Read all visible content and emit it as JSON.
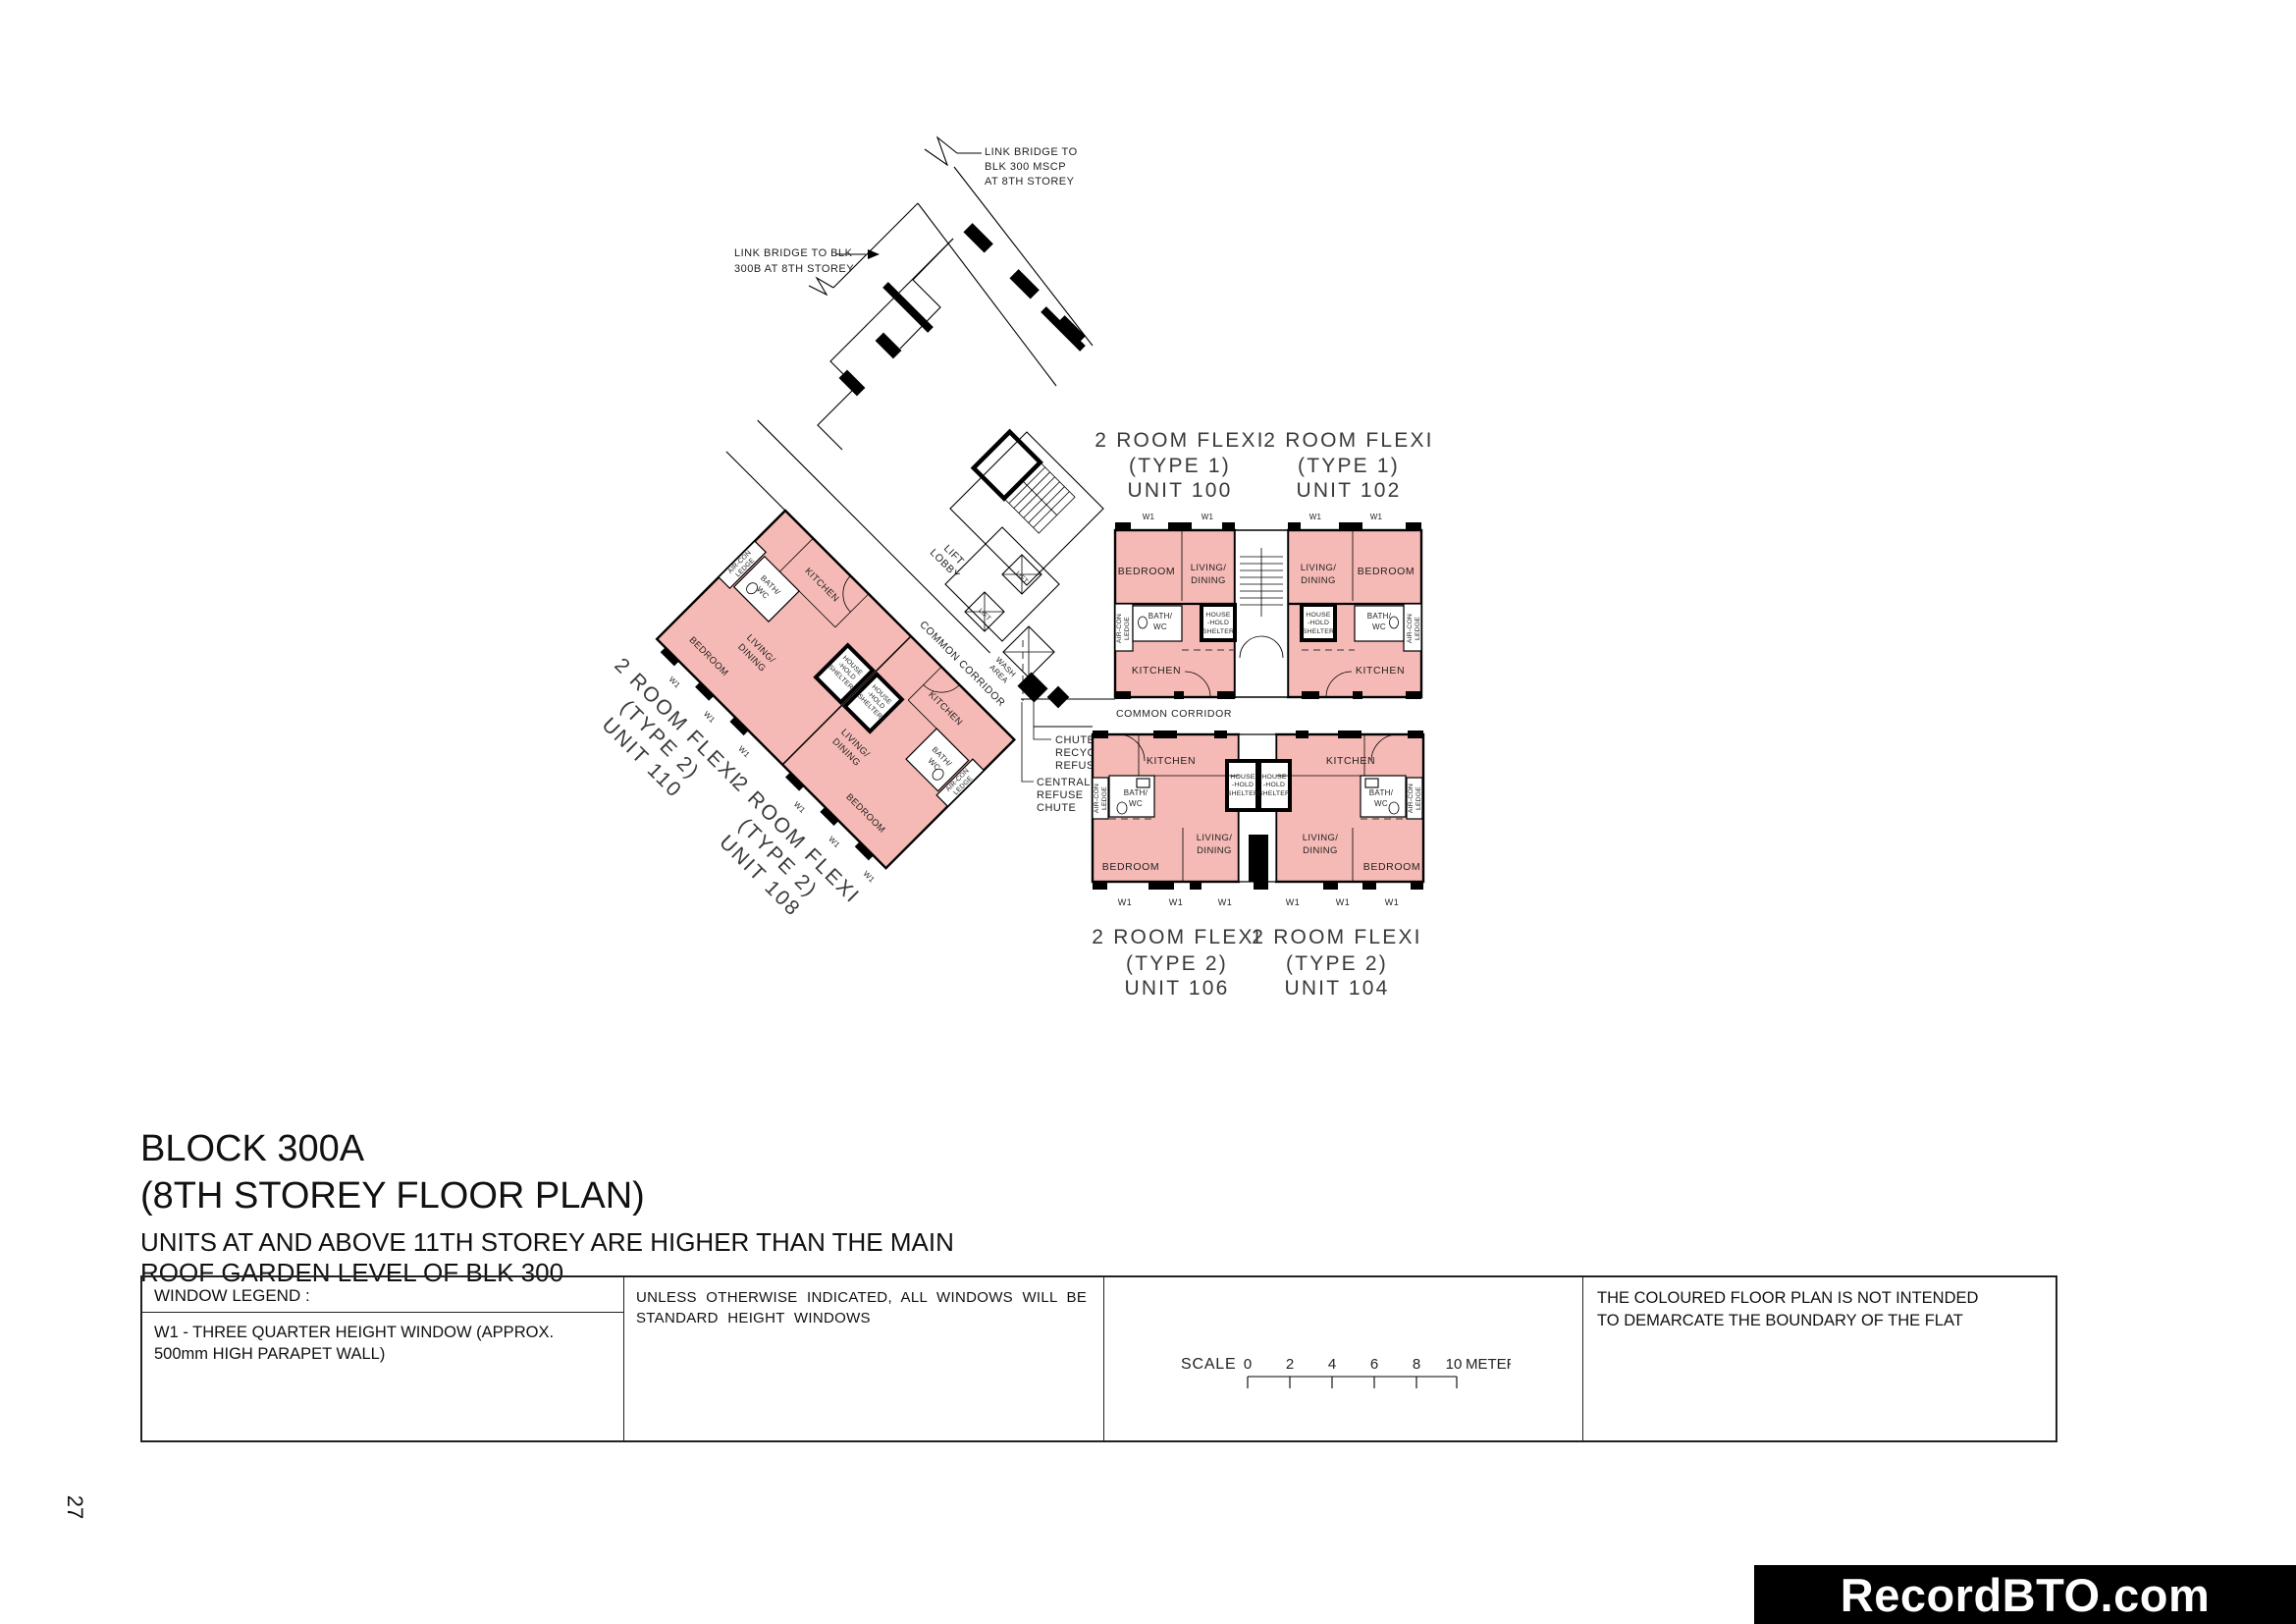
{
  "page": {
    "number": "27"
  },
  "watermark": {
    "text": "RecordBTO.com"
  },
  "title_block": {
    "block": "BLOCK 300A",
    "subtitle": "(8TH STOREY FLOOR PLAN)",
    "note_line1": "UNITS AT AND ABOVE 11TH STOREY ARE HIGHER THAN THE MAIN",
    "note_line2": "ROOF GARDEN LEVEL OF BLK 300"
  },
  "legend": {
    "window_legend_title": "WINDOW LEGEND :",
    "window_legend_item": "W1 - THREE QUARTER HEIGHT WINDOW (APPROX. 500mm HIGH PARAPET WALL)",
    "windows_note_line1": "UNLESS OTHERWISE INDICATED, ALL WINDOWS WILL BE",
    "windows_note_line2": "STANDARD HEIGHT WINDOWS",
    "scale_label": "SCALE",
    "scale_ticks": [
      "0",
      "2",
      "4",
      "6",
      "8",
      "10"
    ],
    "scale_unit": "METER",
    "coloured_note_line1": "THE COLOURED FLOOR PLAN IS NOT INTENDED",
    "coloured_note_line2": "TO DEMARCATE THE BOUNDARY OF THE FLAT"
  },
  "plan": {
    "colors": {
      "unit_fill": "#f6bab6",
      "wall": "#000000"
    },
    "rooms": {
      "bedroom": "BEDROOM",
      "living1": "LIVING/",
      "living2": "DINING",
      "kitchen": "KITCHEN",
      "bath1": "BATH/",
      "bath2": "WC",
      "hh1": "HOUSE",
      "hh2": "-HOLD",
      "hh3": "SHELTER",
      "ac1": "AIR-CON",
      "ac2": "LEDGE",
      "w1": "W1"
    },
    "units": {
      "u100": {
        "l1": "2 ROOM FLEXI",
        "l2": "(TYPE 1)",
        "l3": "UNIT 100"
      },
      "u102": {
        "l1": "2 ROOM FLEXI",
        "l2": "(TYPE 1)",
        "l3": "UNIT 102"
      },
      "u104": {
        "l1": "2 ROOM FLEXI",
        "l2": "(TYPE 2)",
        "l3": "UNIT 104"
      },
      "u106": {
        "l1": "2 ROOM FLEXI",
        "l2": "(TYPE 2)",
        "l3": "UNIT 106"
      },
      "u108": {
        "l1": "2 ROOM FLEXI",
        "l2": "(TYPE 2)",
        "l3": "UNIT 108"
      },
      "u110": {
        "l1": "2 ROOM FLEXI",
        "l2": "(TYPE 2)",
        "l3": "UNIT 110"
      }
    },
    "annotations": {
      "mscp": [
        "LINK BRIDGE TO",
        "BLK 300 MSCP",
        "AT 8TH STOREY"
      ],
      "b300b": [
        "LINK BRIDGE TO BLK",
        "300B AT 8TH STOREY"
      ],
      "lift_lobby": [
        "LIFT",
        "LOBBY"
      ],
      "lift": "LIFT",
      "wash": [
        "WASH",
        "AREA"
      ],
      "common_corridor": "COMMON CORRIDOR",
      "chute_recyclable": [
        "CHUTE FOR",
        "RECYCLABLE",
        "REFUSE"
      ],
      "centralised": [
        "CENTRALISED",
        "REFUSE",
        "CHUTE"
      ]
    }
  }
}
